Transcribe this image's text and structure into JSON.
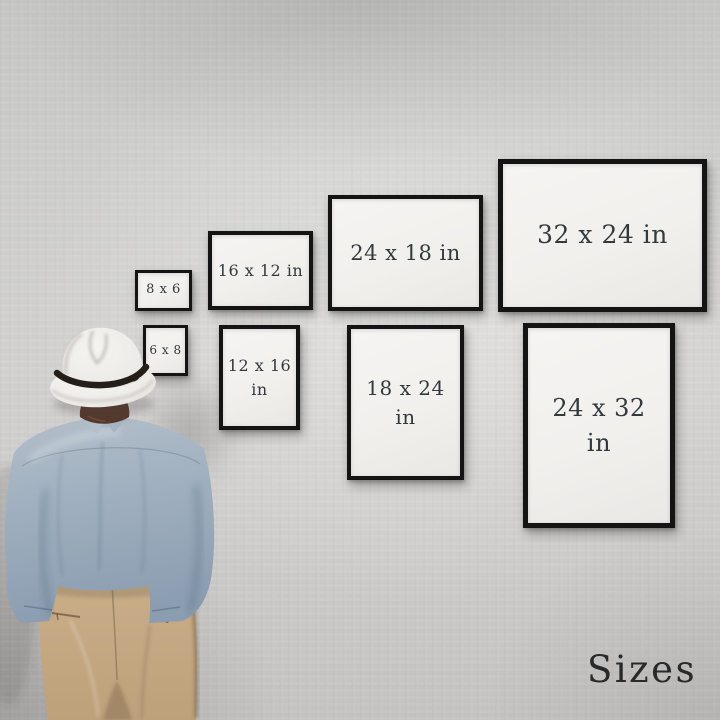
{
  "footer": {
    "label": "Sizes"
  },
  "frames": {
    "top_row": [
      {
        "label": "8 x 6"
      },
      {
        "label": "16 x 12 in"
      },
      {
        "label": "24 x 18 in"
      },
      {
        "label": "32 x 24 in"
      }
    ],
    "bottom_row": [
      {
        "label": "6 x 8"
      },
      {
        "line1": "12 x 16",
        "line2": "in"
      },
      {
        "line1": "18 x 24",
        "line2": "in"
      },
      {
        "line1": "24 x 32",
        "line2": "in"
      }
    ]
  },
  "figure": {
    "name": "man-viewing-wall-from-behind"
  },
  "colors": {
    "wall": "#cfcecd",
    "frame_border": "#141414",
    "frame_mat": "#f3f2ef",
    "frame_label_text": "#333a3d",
    "footer_text": "#27292b",
    "hat": "#efede9",
    "hat_band": "#251e18",
    "hair": "#55392c",
    "shirt": "#9fafbf",
    "pants": "#c3a883"
  }
}
